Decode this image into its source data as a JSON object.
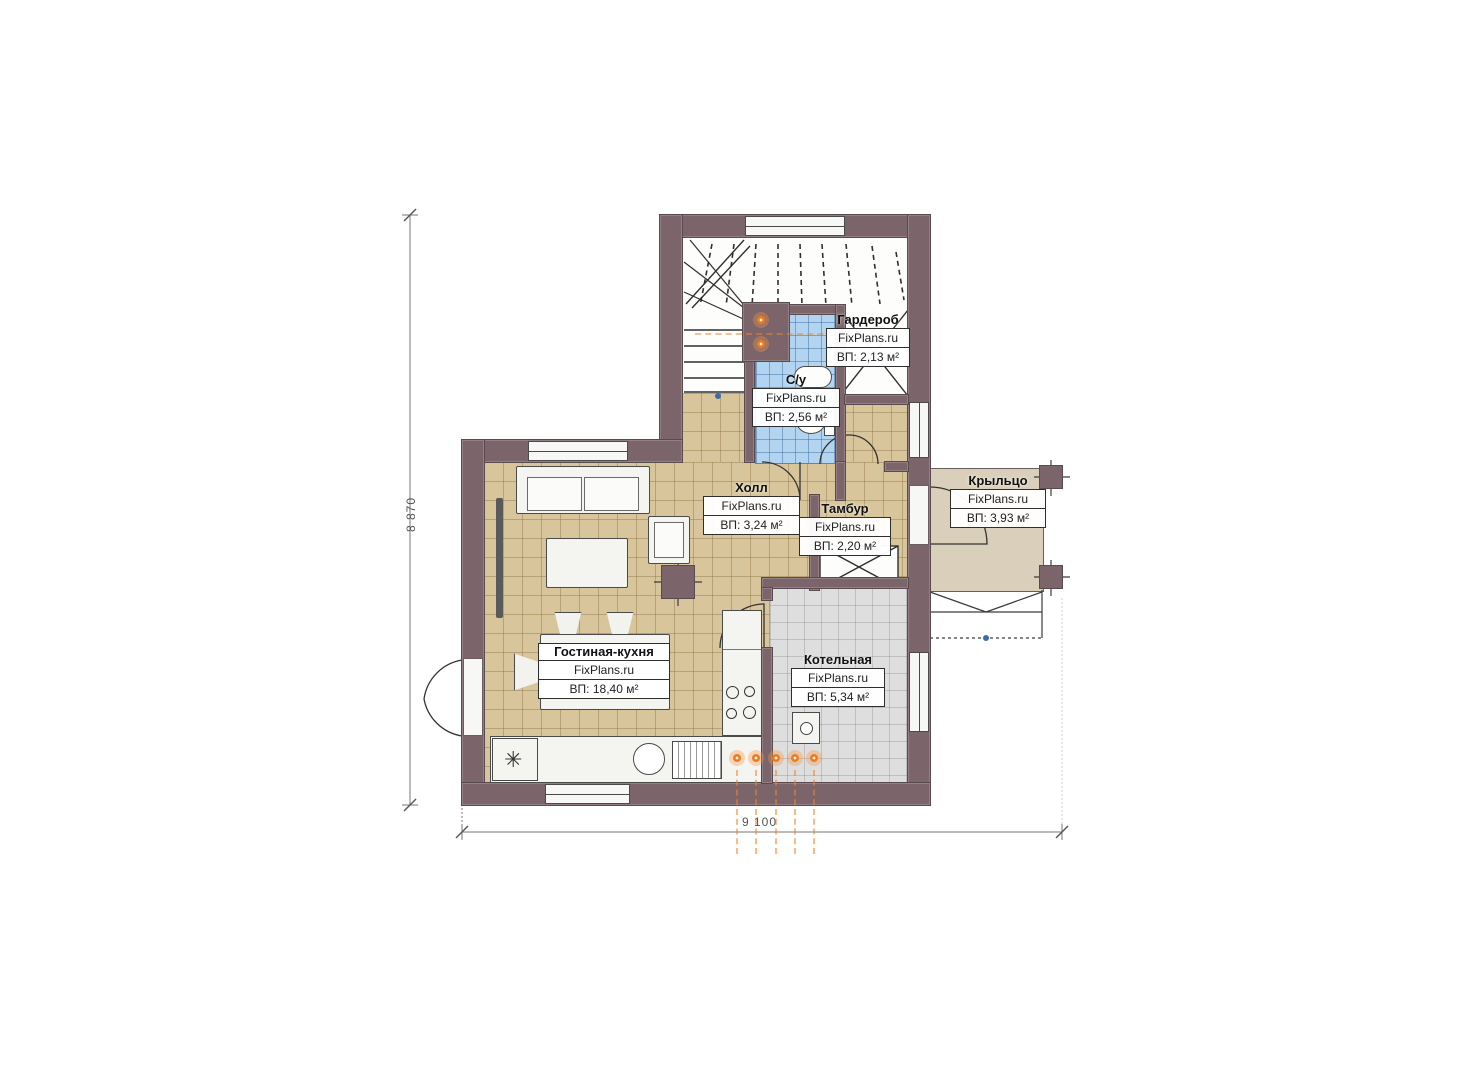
{
  "watermark": "FixPlans.ru",
  "rooms": [
    {
      "name": "Гардероб",
      "watermark": "FixPlans.ru",
      "area": "ВП: 2,13 м²"
    },
    {
      "name": "С/у",
      "watermark": "FixPlans.ru",
      "area": "ВП: 2,56 м²"
    },
    {
      "name": "Холл",
      "watermark": "FixPlans.ru",
      "area": "ВП: 3,24 м²"
    },
    {
      "name": "Тамбур",
      "watermark": "FixPlans.ru",
      "area": "ВП: 2,20 м²"
    },
    {
      "name": "Крыльцо",
      "watermark": "FixPlans.ru",
      "area": "ВП: 3,93 м²"
    },
    {
      "name": "Гостиная-кухня",
      "watermark": "FixPlans.ru",
      "area": "ВП: 18,40 м²"
    },
    {
      "name": "Котельная",
      "watermark": "FixPlans.ru",
      "area": "ВП: 5,34 м²"
    }
  ],
  "dimensions": {
    "left": "8 870",
    "bottom": "9 100"
  },
  "symbols": {
    "fridge": "✳"
  },
  "colors": {
    "wall": "#7b656a",
    "floor_beige": "#d8c59c",
    "floor_gray": "#dedede",
    "floor_blue": "#b3d4f0",
    "porch": "#d9cfba",
    "heating_orange": "#ee7b1f"
  }
}
